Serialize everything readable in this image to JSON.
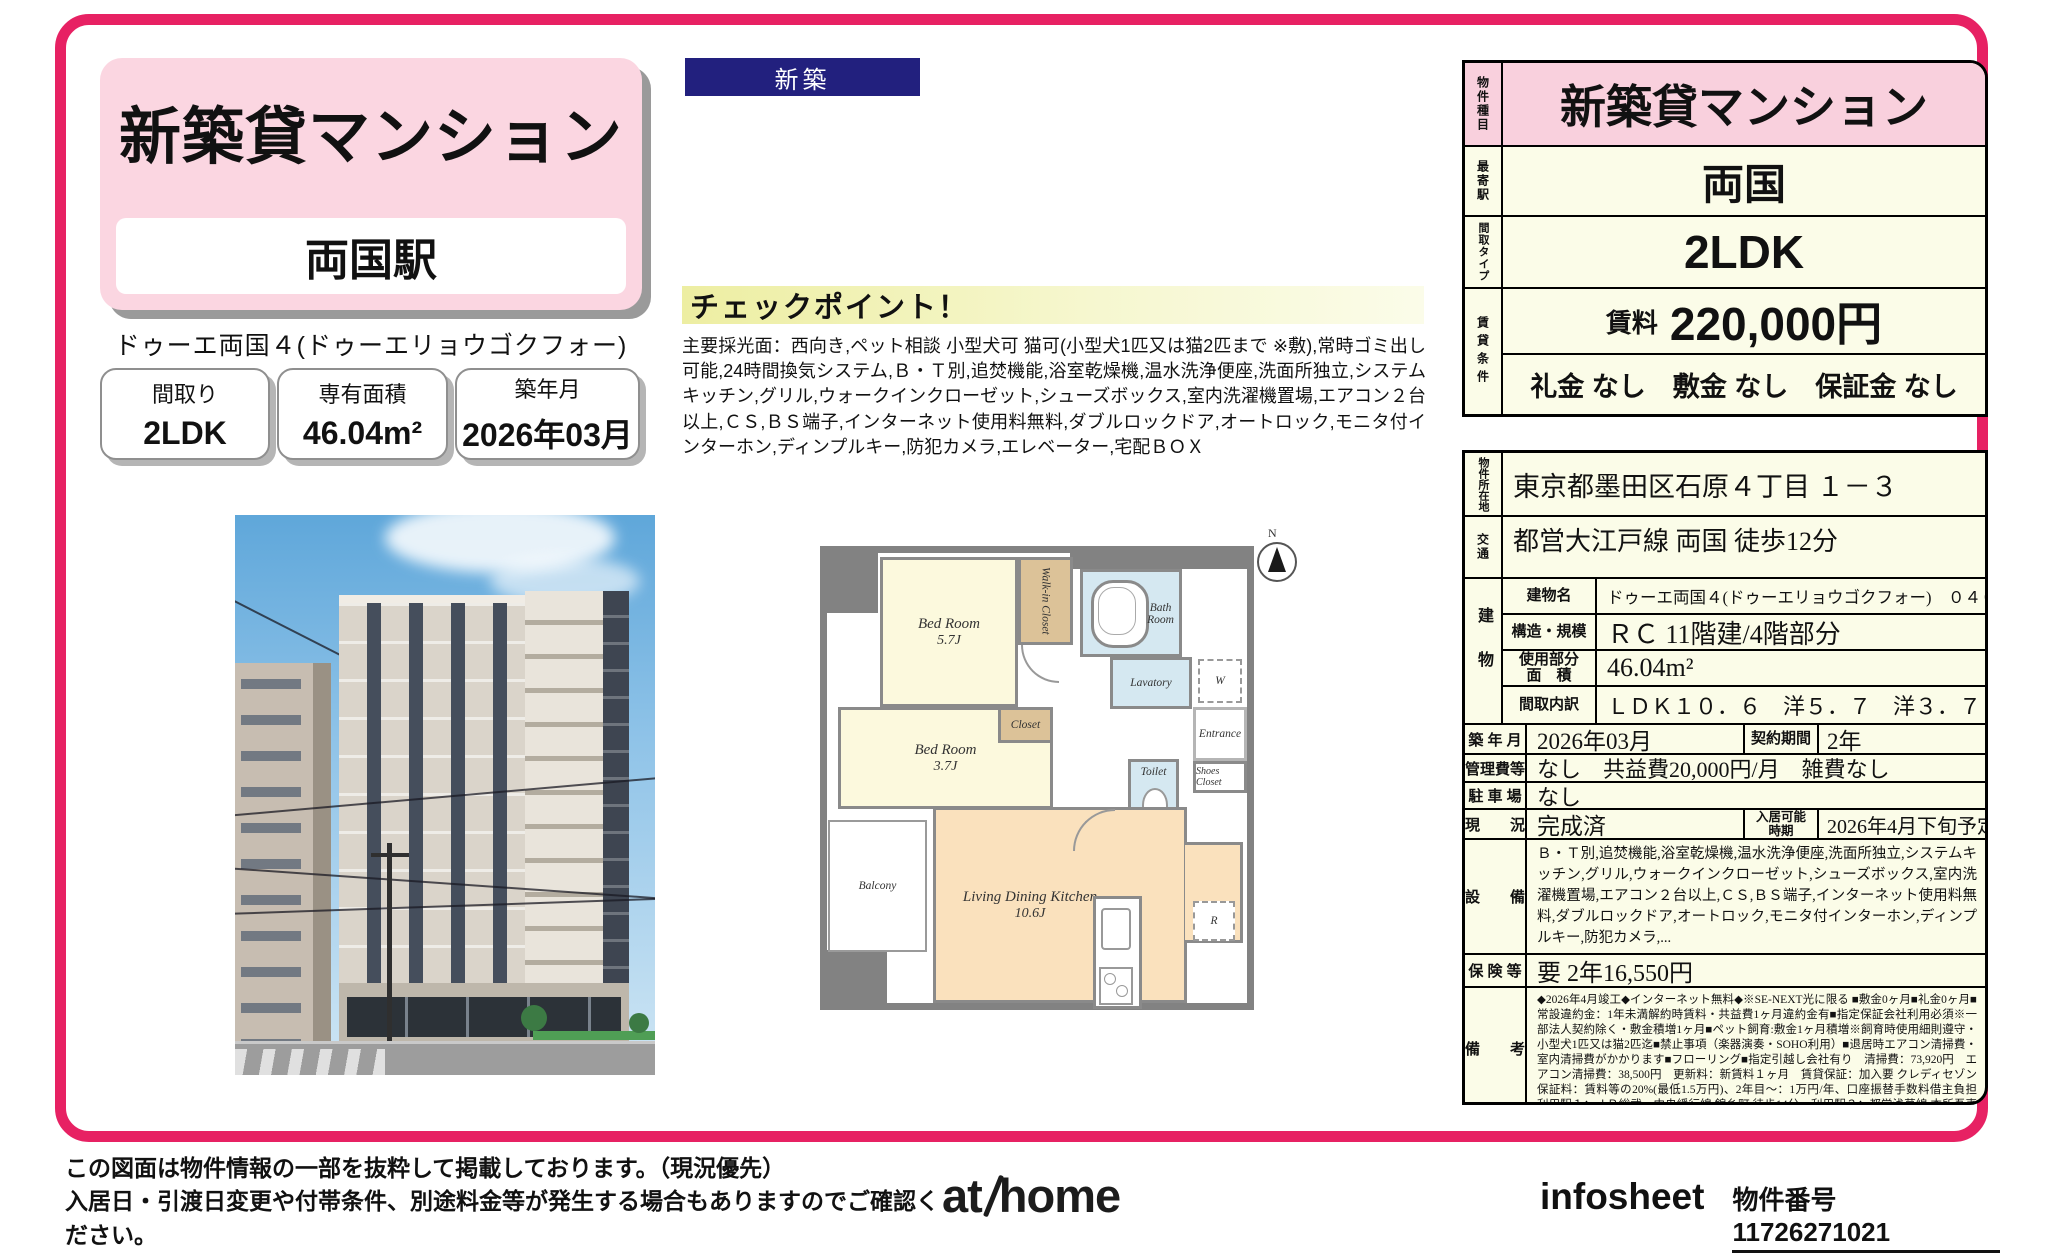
{
  "colors": {
    "frame_pink": "#e72163",
    "title_pink": "#fbd6e1",
    "navy": "#22207e",
    "cream": "#fbfce8",
    "row_pink": "#f9d0dd"
  },
  "badge_new": "新築",
  "header": {
    "title": "新築貸マンション",
    "station": "両国駅",
    "building_code": "ドゥーエ両国４(ドゥーエリョウゴクフォー)　０４０２",
    "stats": [
      {
        "label": "間取り",
        "value": "2LDK"
      },
      {
        "label": "専有面積",
        "value": "46.04m²"
      },
      {
        "label": "築年月",
        "value": "2026年03月"
      }
    ]
  },
  "checkpoint": {
    "title": "チェックポイント！",
    "body": "主要採光面：西向き,ペット相談 小型犬可 猫可(小型犬1匹又は猫2匹まで ※敷),常時ゴミ出し可能,24時間換気システム,Ｂ・Ｔ別,追焚機能,浴室乾燥機,温水洗浄便座,洗面所独立,システムキッチン,グリル,ウォークインクローゼット,シューズボックス,室内洗濯機置場,エアコン２台以上,ＣＳ,ＢＳ端子,インターネット使用料無料,ダブルロックドア,オートロック,モニタ付インターホン,ディンプルキー,防犯カメラ,エレベーター,宅配ＢＯＸ"
  },
  "summary": {
    "property_type_label": "物件種目",
    "property_type": "新築貸マンション",
    "station_label": "最寄駅",
    "station": "両国",
    "layout_label": "間取タイプ",
    "layout": "2LDK",
    "terms_label": "賃貸条件",
    "rent_label": "賃料",
    "rent": "220,000円",
    "fees": "礼金 なし　敷金 なし　保証金 なし"
  },
  "details": {
    "address_label": "物件所在地",
    "address": "東京都墨田区石原４丁目 １－３",
    "access_label": "交通",
    "access": "都営大江戸線 両国 徒歩12分",
    "building_label": "建物",
    "building_rows": [
      {
        "label": "建物名",
        "value": "ドゥーエ両国４(ドゥーエリョウゴクフォー)　０４０２"
      },
      {
        "label": "構造・規模",
        "value": "ＲＣ 11階建/4階部分"
      },
      {
        "label": "使用部分\n面　積",
        "value": "46.04m²"
      },
      {
        "label": "間取内訳",
        "value": "ＬＤＫ１０．６　洋５．７　洋３．７"
      }
    ],
    "built_label": "築 年 月",
    "built": "2026年03月",
    "contract_label": "契約期間",
    "contract": "2年",
    "mgmt_label": "管理費等",
    "mgmt": "なし　共益費20,000円/月　雑費なし",
    "parking_label": "駐 車 場",
    "parking": "なし",
    "status_label": "現　　況",
    "status": "完成済",
    "movein_label": "入居可能\n時期",
    "movein": "2026年4月下旬予定",
    "equipment_label": "設　　備",
    "equipment": "Ｂ・Ｔ別,追焚機能,浴室乾燥機,温水洗浄便座,洗面所独立,システムキッチン,グリル,ウォークインクローゼット,シューズボックス,室内洗濯機置場,エアコン２台以上,ＣＳ,ＢＳ端子,インターネット使用料無料,ダブルロックドア,オートロック,モニタ付インターホン,ディンプルキー,防犯カメラ,...",
    "insurance_label": "保 険 等",
    "insurance": "要 2年16,550円",
    "notes_label": "備　　考",
    "notes": "◆2026年4月竣工◆インターネット無料◆※SE-NEXT光に限る ■敷金0ヶ月■礼金0ヶ月■常設違約金：1年未満解約時賃料・共益費1ヶ月違約金有■指定保証会社利用必須※一部法人契約除く・敷金積増1ヶ月■ペット飼育:敷金1ヶ月積増※飼育時使用細則遵守・小型犬1匹又は猫2匹迄■禁止事項（楽器演奏・SOHO利用）■退居時エアコン清掃費・室内清掃費がかかります■フローリング■指定引越し会社有り　清掃費：73,920円　エアコン清掃費：38,500円　更新料：新賃料１ヶ月　賃貸保証：加入要 クレディセゾン　保証料：賃料等の20%(最低1.5万円)、2年目～：1万円/年、口座振替手数料借主負担　利用駅１：ＪＲ総武・中央緩行線 錦糸町 徒歩14分　利用駅２：都営浅草線 本所吾妻橋 徒歩13分"
  },
  "floorplan": {
    "bedroom1": {
      "name": "Bed Room",
      "size": "5.7J"
    },
    "bedroom2": {
      "name": "Bed Room",
      "size": "3.7J"
    },
    "ldk": {
      "name": "Living Dining Kitchen",
      "size": "10.6J"
    },
    "wic": "Walk-in Closet",
    "closet": "Closet",
    "bath": "Bath\nRoom",
    "lavatory": "Lavatory",
    "toilet": "Toilet",
    "entrance": "Entrance",
    "shoes": "Shoes Closet",
    "balcony": "Balcony",
    "washer": "W",
    "fridge": "R",
    "compass": "N"
  },
  "footer": {
    "note1": "この図面は物件情報の一部を抜粋して掲載しております。（現況優先）",
    "note2": "入居日・引渡日変更や付帯条件、別途料金等が発生する場合もありますのでご確認ください。",
    "logo_at": "at",
    "logo_home": "home",
    "infosheet": "infosheet",
    "property_no": "物件番号　11726271021"
  }
}
